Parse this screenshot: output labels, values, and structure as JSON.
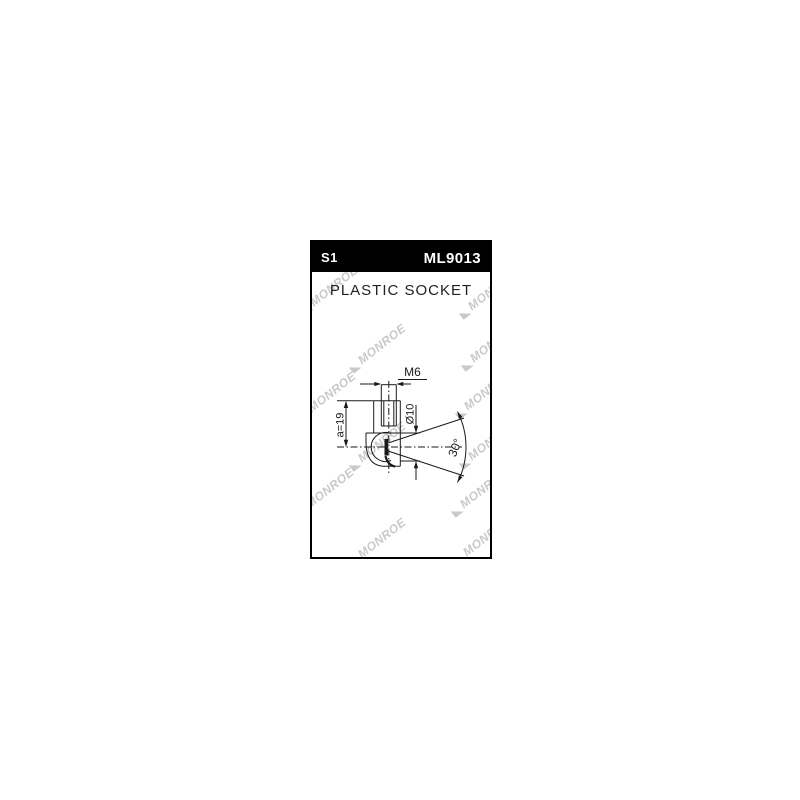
{
  "page": {
    "background": "#ffffff"
  },
  "card": {
    "border_color": "#000000",
    "header": {
      "background": "#000000",
      "text_color": "#ffffff",
      "left_code": "S1",
      "part_number": "ML9013"
    },
    "title": "PLASTIC SOCKET"
  },
  "drawing": {
    "line_color": "#1a1a1a",
    "labels": {
      "thread": "M6",
      "diameter": "Ø10",
      "dim_a": "a=19",
      "angle": "30°"
    }
  },
  "watermark": {
    "text": "MONROE",
    "color": "#c9c9c9",
    "positions": [
      {
        "x": -10,
        "y": 62
      },
      {
        "x": 148,
        "y": 66
      },
      {
        "x": 38,
        "y": 120
      },
      {
        "x": 150,
        "y": 118
      },
      {
        "x": -12,
        "y": 168
      },
      {
        "x": 144,
        "y": 166
      },
      {
        "x": 38,
        "y": 218
      },
      {
        "x": 148,
        "y": 216
      },
      {
        "x": -14,
        "y": 264
      },
      {
        "x": 140,
        "y": 264
      },
      {
        "x": 38,
        "y": 314
      },
      {
        "x": 143,
        "y": 312
      }
    ]
  }
}
